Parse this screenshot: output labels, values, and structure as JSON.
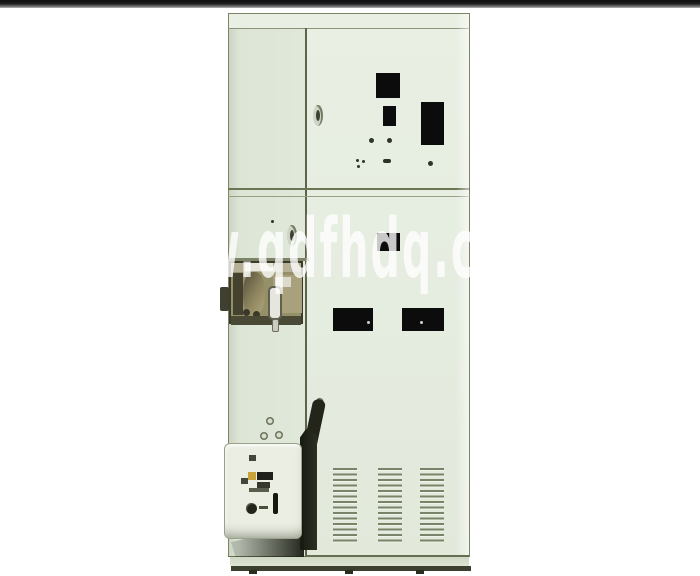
{
  "scene": {
    "description": "Catalogue photograph of a tall pale-green electrical switchgear / power distribution cabinet on a white background",
    "watermark_text": "w.qdfhdq.c",
    "colors": {
      "background": "#ffffff",
      "top_border_bar": "#1c1c1c",
      "cabinet_body": "#e6ede1",
      "cabinet_left_column": "#dde5d6",
      "frame_lines": "#6d7454",
      "cutout_windows": "#0c0c0c",
      "mechanism_recess": "#93906a",
      "control_box": "#eaeee3",
      "shadow": "#20241a",
      "vent_slots": "#6c785c",
      "base": "#3a3f2e",
      "watermark": "rgba(255,255,255,0.78)"
    }
  }
}
